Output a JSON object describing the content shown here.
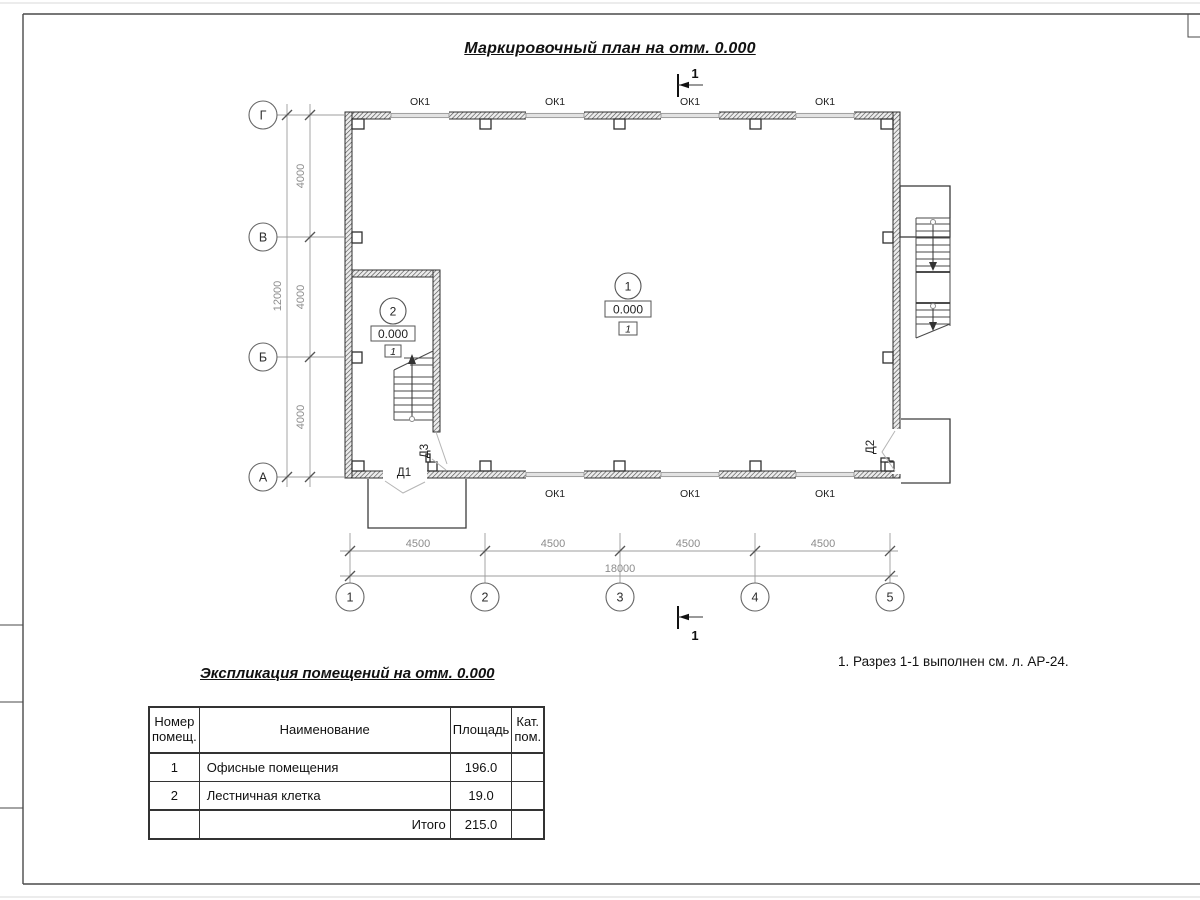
{
  "page": {
    "main_title": "Маркировочный план на отм. 0.000",
    "note": "1. Разрез 1-1 выполнен см. л. АР-24."
  },
  "plan": {
    "window_label": "ОК1",
    "door_labels": {
      "d1": "Д1",
      "d2": "Д2",
      "d3": "Д3"
    },
    "section_label": "1",
    "rooms": [
      {
        "number": "1",
        "elevation": "0.000",
        "floor_type": "1"
      },
      {
        "number": "2",
        "elevation": "0.000",
        "floor_type": "1"
      }
    ],
    "axes_rows": [
      "Г",
      "В",
      "Б",
      "А"
    ],
    "axes_cols": [
      "1",
      "2",
      "3",
      "4",
      "5"
    ],
    "dims": {
      "row_segments": [
        "4000",
        "4000",
        "4000"
      ],
      "row_total": "12000",
      "col_segments": [
        "4500",
        "4500",
        "4500",
        "4500"
      ],
      "col_total": "18000"
    }
  },
  "table": {
    "title": "Экспликация помещений на отм. 0.000",
    "headers": [
      "Номер помещ.",
      "Наименование",
      "Площадь",
      "Кат. пом."
    ],
    "rows": [
      [
        "1",
        "Офисные помещения",
        "196.0",
        ""
      ],
      [
        "2",
        "Лестничная клетка",
        "19.0",
        ""
      ]
    ],
    "total_label": "Итого",
    "total_value": "215.0"
  }
}
